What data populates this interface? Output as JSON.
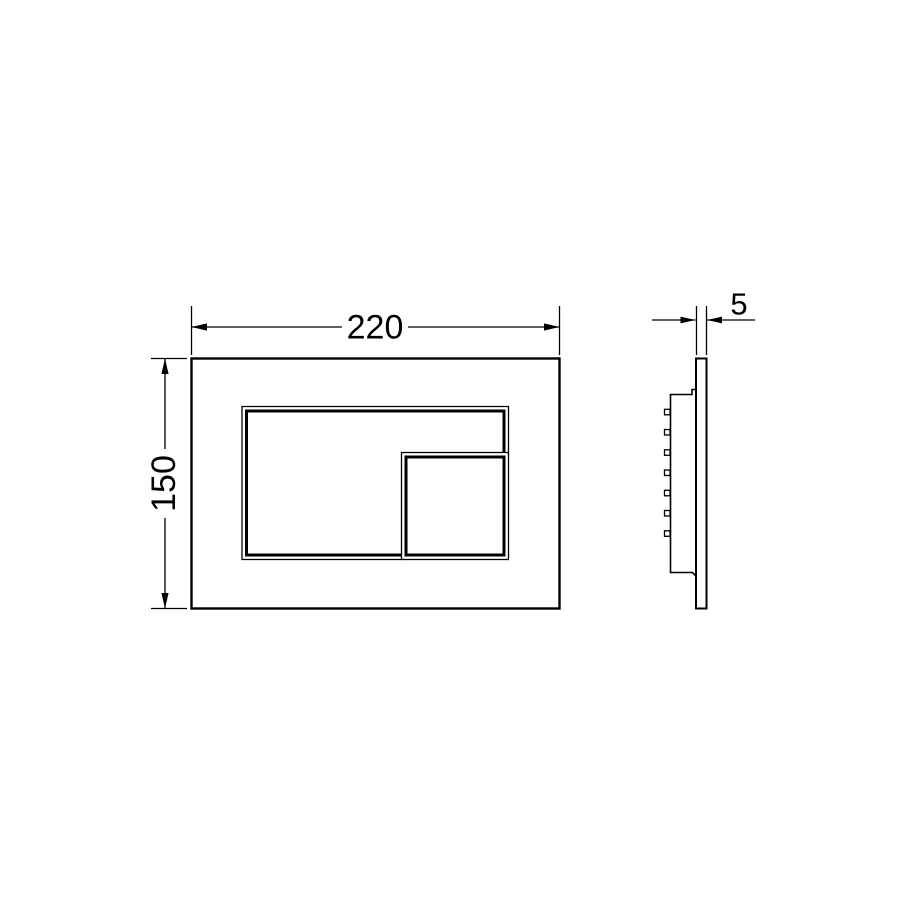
{
  "dimensions": {
    "front_width_mm": "220",
    "front_height_mm": "150",
    "side_thickness_mm": "5"
  },
  "colors": {
    "line": "#000000",
    "background": "#ffffff"
  }
}
